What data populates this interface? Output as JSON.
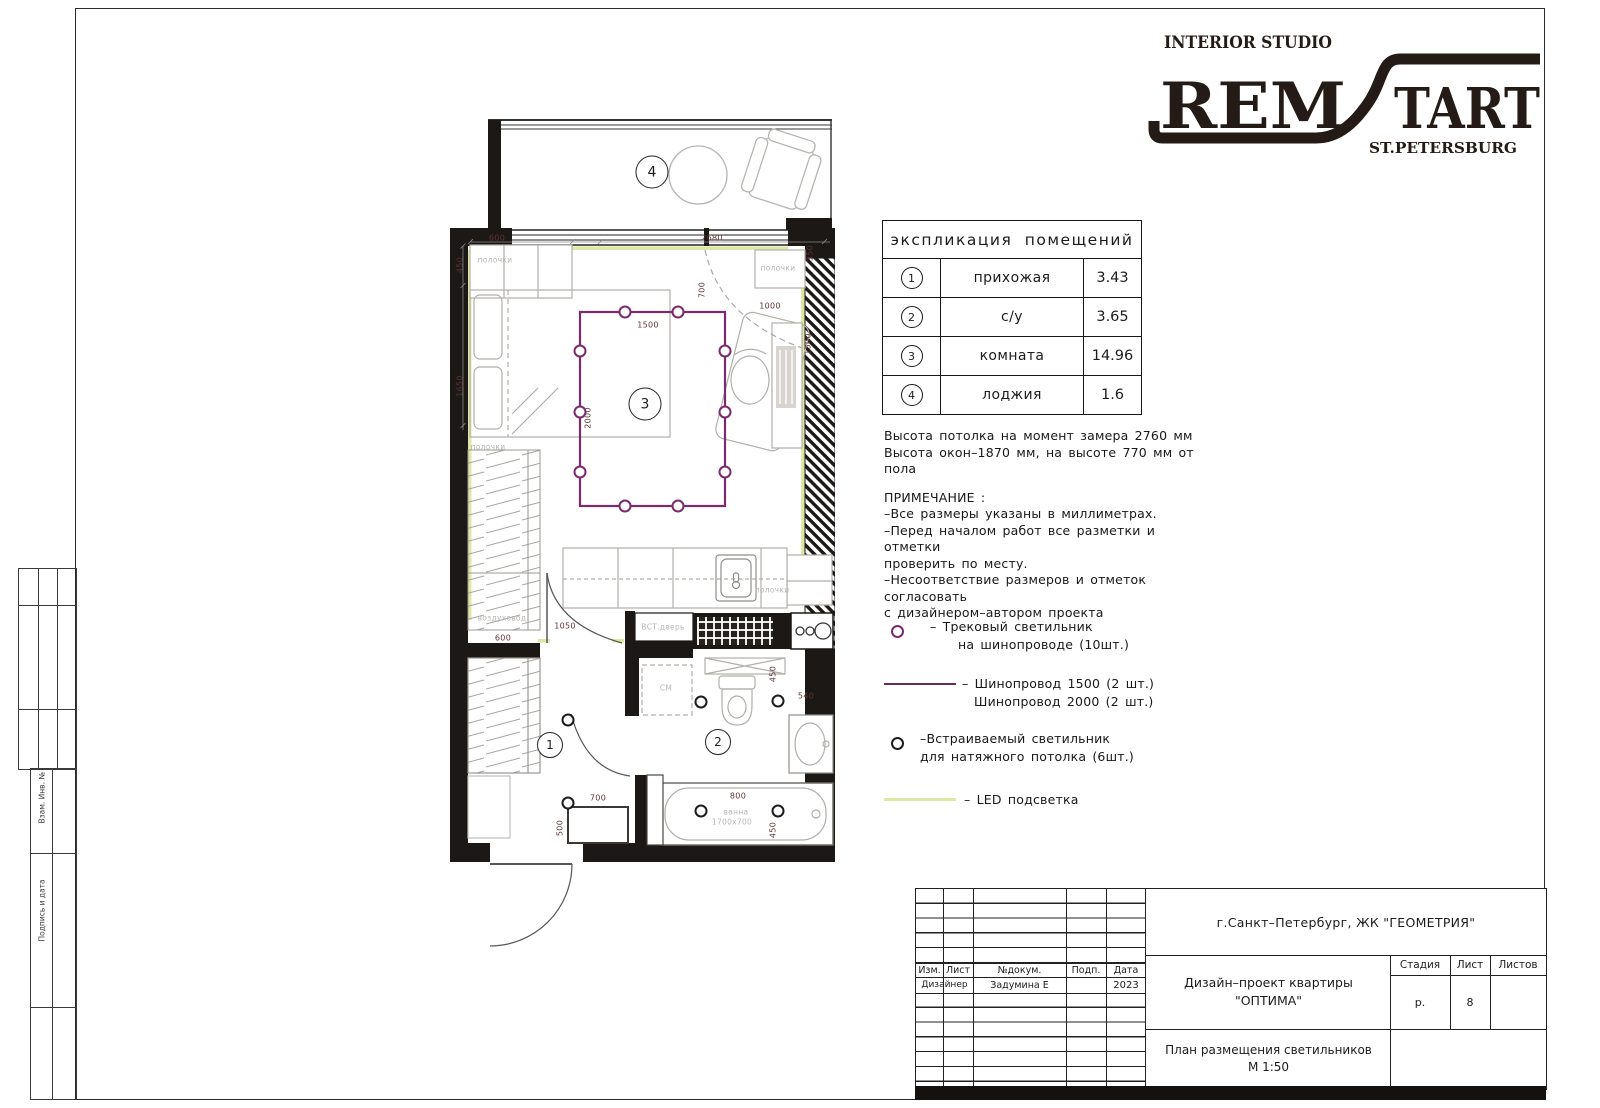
{
  "logo": {
    "tagline": "INTERIOR STUDIO",
    "brand_left": "REM",
    "brand_right": "TART",
    "city": "ST.PETERSBURG"
  },
  "frame": {
    "stamp_label_1": "Взам. Инв. №",
    "stamp_label_2": "Подпись и дата"
  },
  "explication": {
    "title": "экспликация помещений",
    "rows": [
      {
        "num": "1",
        "name": "прихожая",
        "area": "3.43"
      },
      {
        "num": "2",
        "name": "с/у",
        "area": "3.65"
      },
      {
        "num": "3",
        "name": "комната",
        "area": "14.96"
      },
      {
        "num": "4",
        "name": "лоджия",
        "area": "1.6"
      }
    ]
  },
  "notes": {
    "height_line1": "Высота потолка на момент замера 2760 мм",
    "height_line2": "Высота окон–1870 мм, на высоте 770 мм от пола",
    "header": "ПРИМЕЧАНИЕ :",
    "line1": "–Все размеры указаны в миллиметрах.",
    "line2": "–Перед началом работ все разметки и отметки",
    "line3": "проверить по месту.",
    "line4": "–Несоответствие размеров и отметок согласовать",
    "line5": "с дизайнером–автором проекта"
  },
  "legend": {
    "track_line1": "–    Трековый светильник",
    "track_line2": "на шинопроводе   (10шт.)",
    "busbar_line1": "– Шинопровод 1500 (2 шт.)",
    "busbar_line2": "Шинопровод 2000 (2 шт.)",
    "recessed_line1": "–Встраиваемый светильник",
    "recessed_line2": "для натяжного потолка   (6шт.)",
    "led_line1": "– LED подсветка"
  },
  "colors": {
    "busbar_track": "#7b2a6e",
    "led_strip": "#dde8a4",
    "dim_text": "#5d3434",
    "wall": "#1b1815",
    "gray_label": "#b8b5b2"
  },
  "plan": {
    "room_markers": [
      {
        "n": "1",
        "x": 100,
        "y": 627,
        "big": false
      },
      {
        "n": "2",
        "x": 268,
        "y": 624,
        "big": false
      },
      {
        "n": "3",
        "x": 195,
        "y": 286,
        "big": true
      },
      {
        "n": "4",
        "x": 202,
        "y": 54,
        "big": true
      }
    ],
    "dims": [
      {
        "t": "600",
        "x": 47,
        "y": 120
      },
      {
        "t": "2680",
        "x": 262,
        "y": 120
      },
      {
        "t": "450",
        "x": 10,
        "y": 147,
        "v": true
      },
      {
        "t": "1650",
        "x": 10,
        "y": 268,
        "v": true
      },
      {
        "t": "700",
        "x": 252,
        "y": 172,
        "v": true
      },
      {
        "t": "350",
        "x": 360,
        "y": 135,
        "v": true
      },
      {
        "t": "1000",
        "x": 320,
        "y": 188
      },
      {
        "t": "1500",
        "x": 358,
        "y": 226,
        "v": true
      },
      {
        "t": "1500",
        "x": 198,
        "y": 207
      },
      {
        "t": "2000",
        "x": 138,
        "y": 300,
        "v": true
      },
      {
        "t": "600",
        "x": 53,
        "y": 520
      },
      {
        "t": "1050",
        "x": 115,
        "y": 508
      },
      {
        "t": "700",
        "x": 148,
        "y": 680
      },
      {
        "t": "500",
        "x": 110,
        "y": 710,
        "v": true
      },
      {
        "t": "450",
        "x": 323,
        "y": 556,
        "v": true
      },
      {
        "t": "540",
        "x": 356,
        "y": 578
      },
      {
        "t": "800",
        "x": 288,
        "y": 678
      },
      {
        "t": "450",
        "x": 323,
        "y": 712,
        "v": true
      }
    ],
    "labels": [
      {
        "t": "полочки",
        "x": 45,
        "y": 142
      },
      {
        "t": "полочки",
        "x": 38,
        "y": 329
      },
      {
        "t": "воздуховод",
        "x": 52,
        "y": 500
      },
      {
        "t": "полочки",
        "x": 328,
        "y": 150
      },
      {
        "t": "полочки",
        "x": 322,
        "y": 472
      },
      {
        "t": "СМ",
        "x": 216,
        "y": 570
      },
      {
        "t": "ВСТ.дверь",
        "x": 213,
        "y": 509
      },
      {
        "t": "ванна",
        "x": 286,
        "y": 694
      },
      {
        "t": "1700х700",
        "x": 282,
        "y": 704
      }
    ],
    "track_lights": [
      {
        "x": 175,
        "y": 194
      },
      {
        "x": 228,
        "y": 194
      },
      {
        "x": 130,
        "y": 233
      },
      {
        "x": 130,
        "y": 294
      },
      {
        "x": 130,
        "y": 354
      },
      {
        "x": 275,
        "y": 233
      },
      {
        "x": 275,
        "y": 294
      },
      {
        "x": 275,
        "y": 354
      },
      {
        "x": 175,
        "y": 388
      },
      {
        "x": 228,
        "y": 388
      }
    ],
    "spot_lights": [
      {
        "x": 118,
        "y": 602
      },
      {
        "x": 118,
        "y": 685
      },
      {
        "x": 251,
        "y": 584
      },
      {
        "x": 328,
        "y": 583
      },
      {
        "x": 251,
        "y": 693
      },
      {
        "x": 328,
        "y": 693
      }
    ]
  },
  "title_block": {
    "location": "г.Санкт–Петербург,  ЖК  \"ГЕОМЕТРИЯ\"",
    "project_line1": "Дизайн–проект квартиры",
    "project_line2": "\"ОПТИМА\"",
    "doc_title": "План размещения светильников",
    "scale": "М 1:50",
    "h_izm": "Изм.",
    "h_list": "Лист",
    "h_dok": "№докум.",
    "h_podp": "Подп.",
    "h_date": "Дата",
    "designer_role": "Дизайнер",
    "designer_name": "Задумина Е",
    "designer_date": "2023",
    "stage_label": "Стадия",
    "sheet_label": "Лист",
    "sheets_label": "Листов",
    "stage_value": "р.",
    "sheet_value": "8",
    "sheets_value": ""
  }
}
